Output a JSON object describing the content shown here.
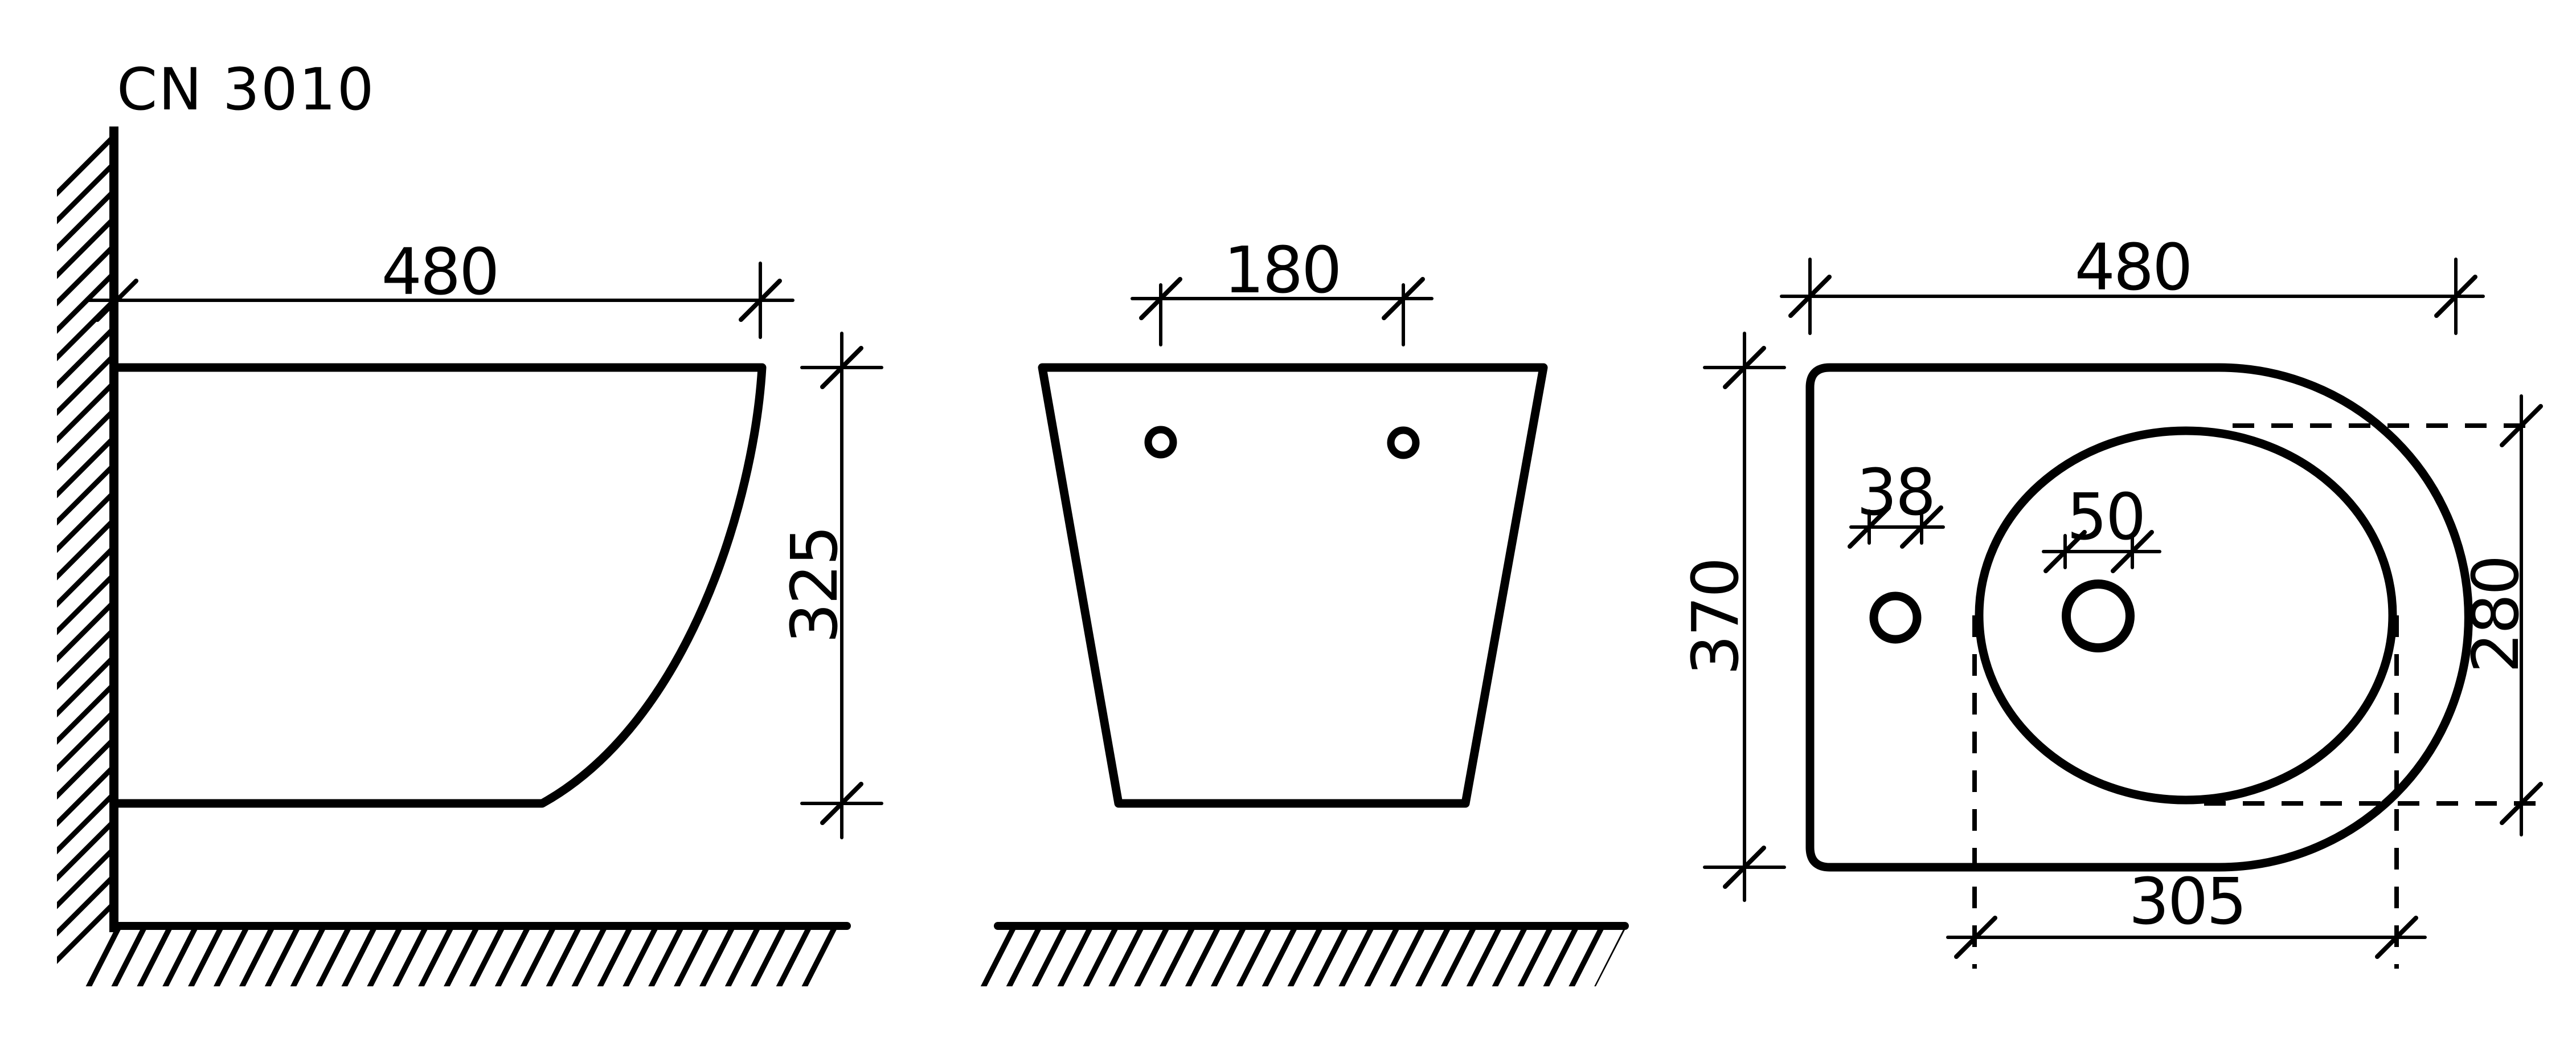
{
  "title": "CN 3010",
  "colors": {
    "ink": "#000000",
    "paper": "#ffffff"
  },
  "views": {
    "side": {
      "label": "side view",
      "dims": {
        "width": "480",
        "height": "325"
      }
    },
    "front": {
      "label": "front view",
      "dims": {
        "bolt_spacing": "180"
      }
    },
    "top": {
      "label": "top view",
      "dims": {
        "width": "480",
        "depth": "370",
        "small_hole": "38",
        "large_hole": "50",
        "bowl_length": "305",
        "bowl_depth": "280"
      }
    }
  }
}
